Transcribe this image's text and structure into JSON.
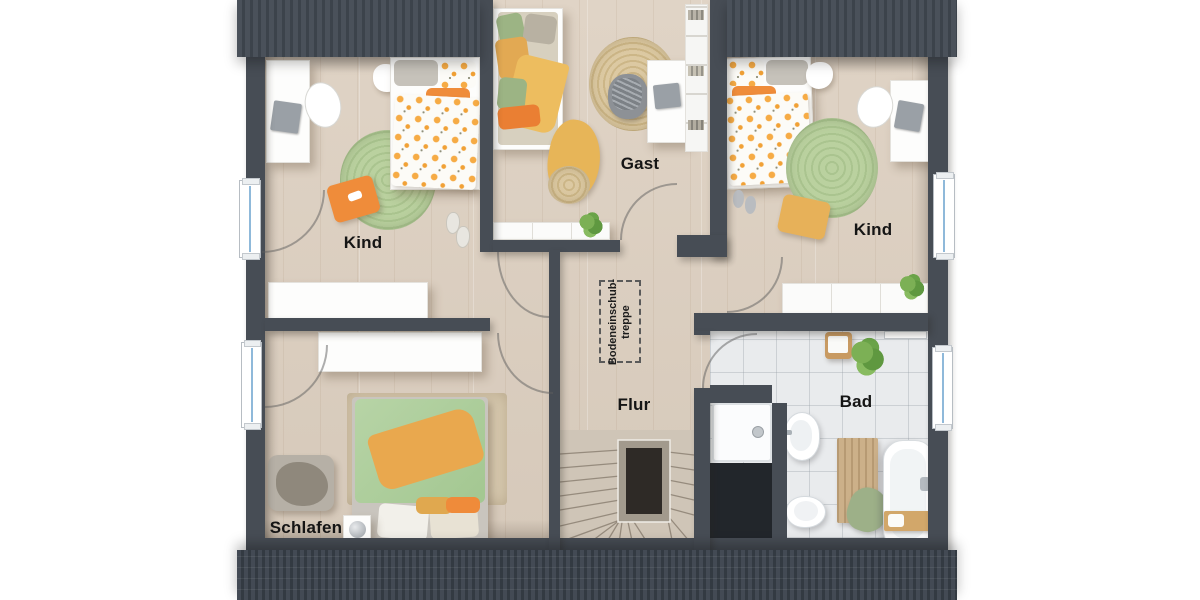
{
  "floor_plan": {
    "rooms": [
      {
        "id": "kind-left",
        "label": "Kind"
      },
      {
        "id": "gast",
        "label": "Gast"
      },
      {
        "id": "kind-right",
        "label": "Kind"
      },
      {
        "id": "schlafen",
        "label": "Schlafen"
      },
      {
        "id": "flur",
        "label": "Flur"
      },
      {
        "id": "bad",
        "label": "Bad"
      }
    ],
    "annotation": {
      "id": "attic-hatch-stair",
      "line1": "Bodeneinschub-",
      "line2": "treppe"
    },
    "colors": {
      "wall": "#474d55",
      "roof_band": "#3c434b",
      "wood_floor": "#dbcec0",
      "bath_tile": "#e9ebed",
      "accent_orange": "#ef8c3a",
      "accent_green": "#aecf9e",
      "accent_mustard": "#e5a94e",
      "radiator_line": "#8fb9da"
    }
  }
}
